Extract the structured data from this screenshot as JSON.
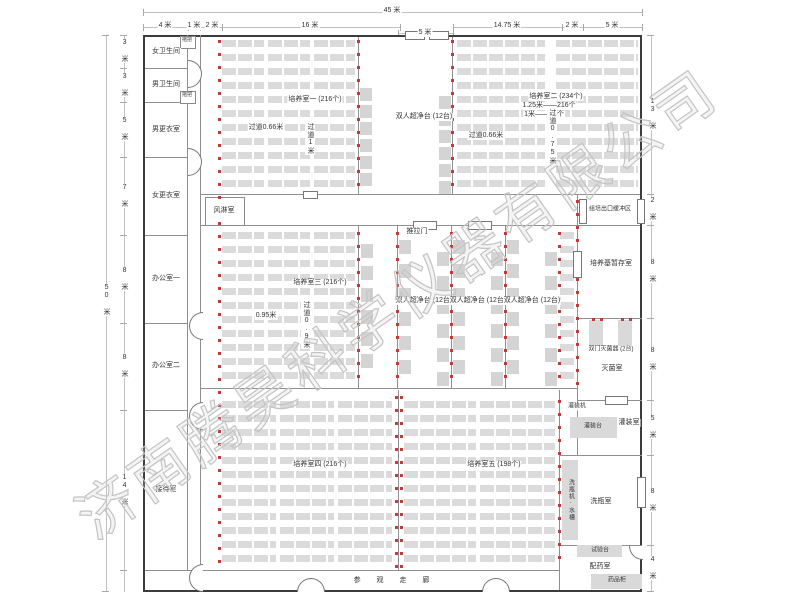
{
  "watermark": "济南腾昊科学仪器有限公司",
  "dims": {
    "top_total": "45 米",
    "top": [
      "4 米",
      "1 米",
      "2 米",
      "16 米",
      "14.75 米",
      "2 米",
      "5 米"
    ],
    "top_sub": "5 米",
    "left_total": "50 米",
    "left": [
      "3 米",
      "3 米",
      "5 米",
      "7 米",
      "8 米",
      "8 米",
      "14 米"
    ],
    "right": [
      "13 米",
      "2 米",
      "8 米",
      "8 米",
      "5 米",
      "8 米",
      "4 米"
    ]
  },
  "rooms": {
    "left": [
      "女卫生间",
      "男卫生间",
      "男更衣室",
      "女更衣室",
      "办公室一",
      "办公室二",
      "接待室"
    ],
    "mop": "拖把",
    "air_shower": "风淋室",
    "culture1": "培养室一 (216个)",
    "culture2": "培养室二 (234个)",
    "culture2_note1": "1.25米——216个",
    "culture2_note2": "1米——18个",
    "culture3": "培养室三 (216个)",
    "culture4": "培养室四 (216个)",
    "culture5": "培养室五 (198个)",
    "buffer": "组培出口缓冲区",
    "medium_storage": "培养基暂存室",
    "sterilizer": "双门灭菌器 (2台)",
    "sterilize_room": "灭菌室",
    "filling_machine": "灌装机",
    "filling_table": "灌装台",
    "filling_room": "灌装室",
    "washer_sink": "洗瓶机·水槽",
    "washing_room": "洗瓶室",
    "test_bench": "试验台",
    "dispensing_room": "配药室",
    "medicine_cabinet": "药品柜",
    "corridor": "参 观 走 廊"
  },
  "labels": {
    "bench12": "双人超净台 (12台)",
    "sliding_door": "推拉门",
    "aisle_066": "过道0.66米",
    "aisle_1m": "过道1米",
    "aisle_075": "过道0.75米",
    "aisle_095": "0.95米",
    "aisle_09": "过道0.9米"
  }
}
